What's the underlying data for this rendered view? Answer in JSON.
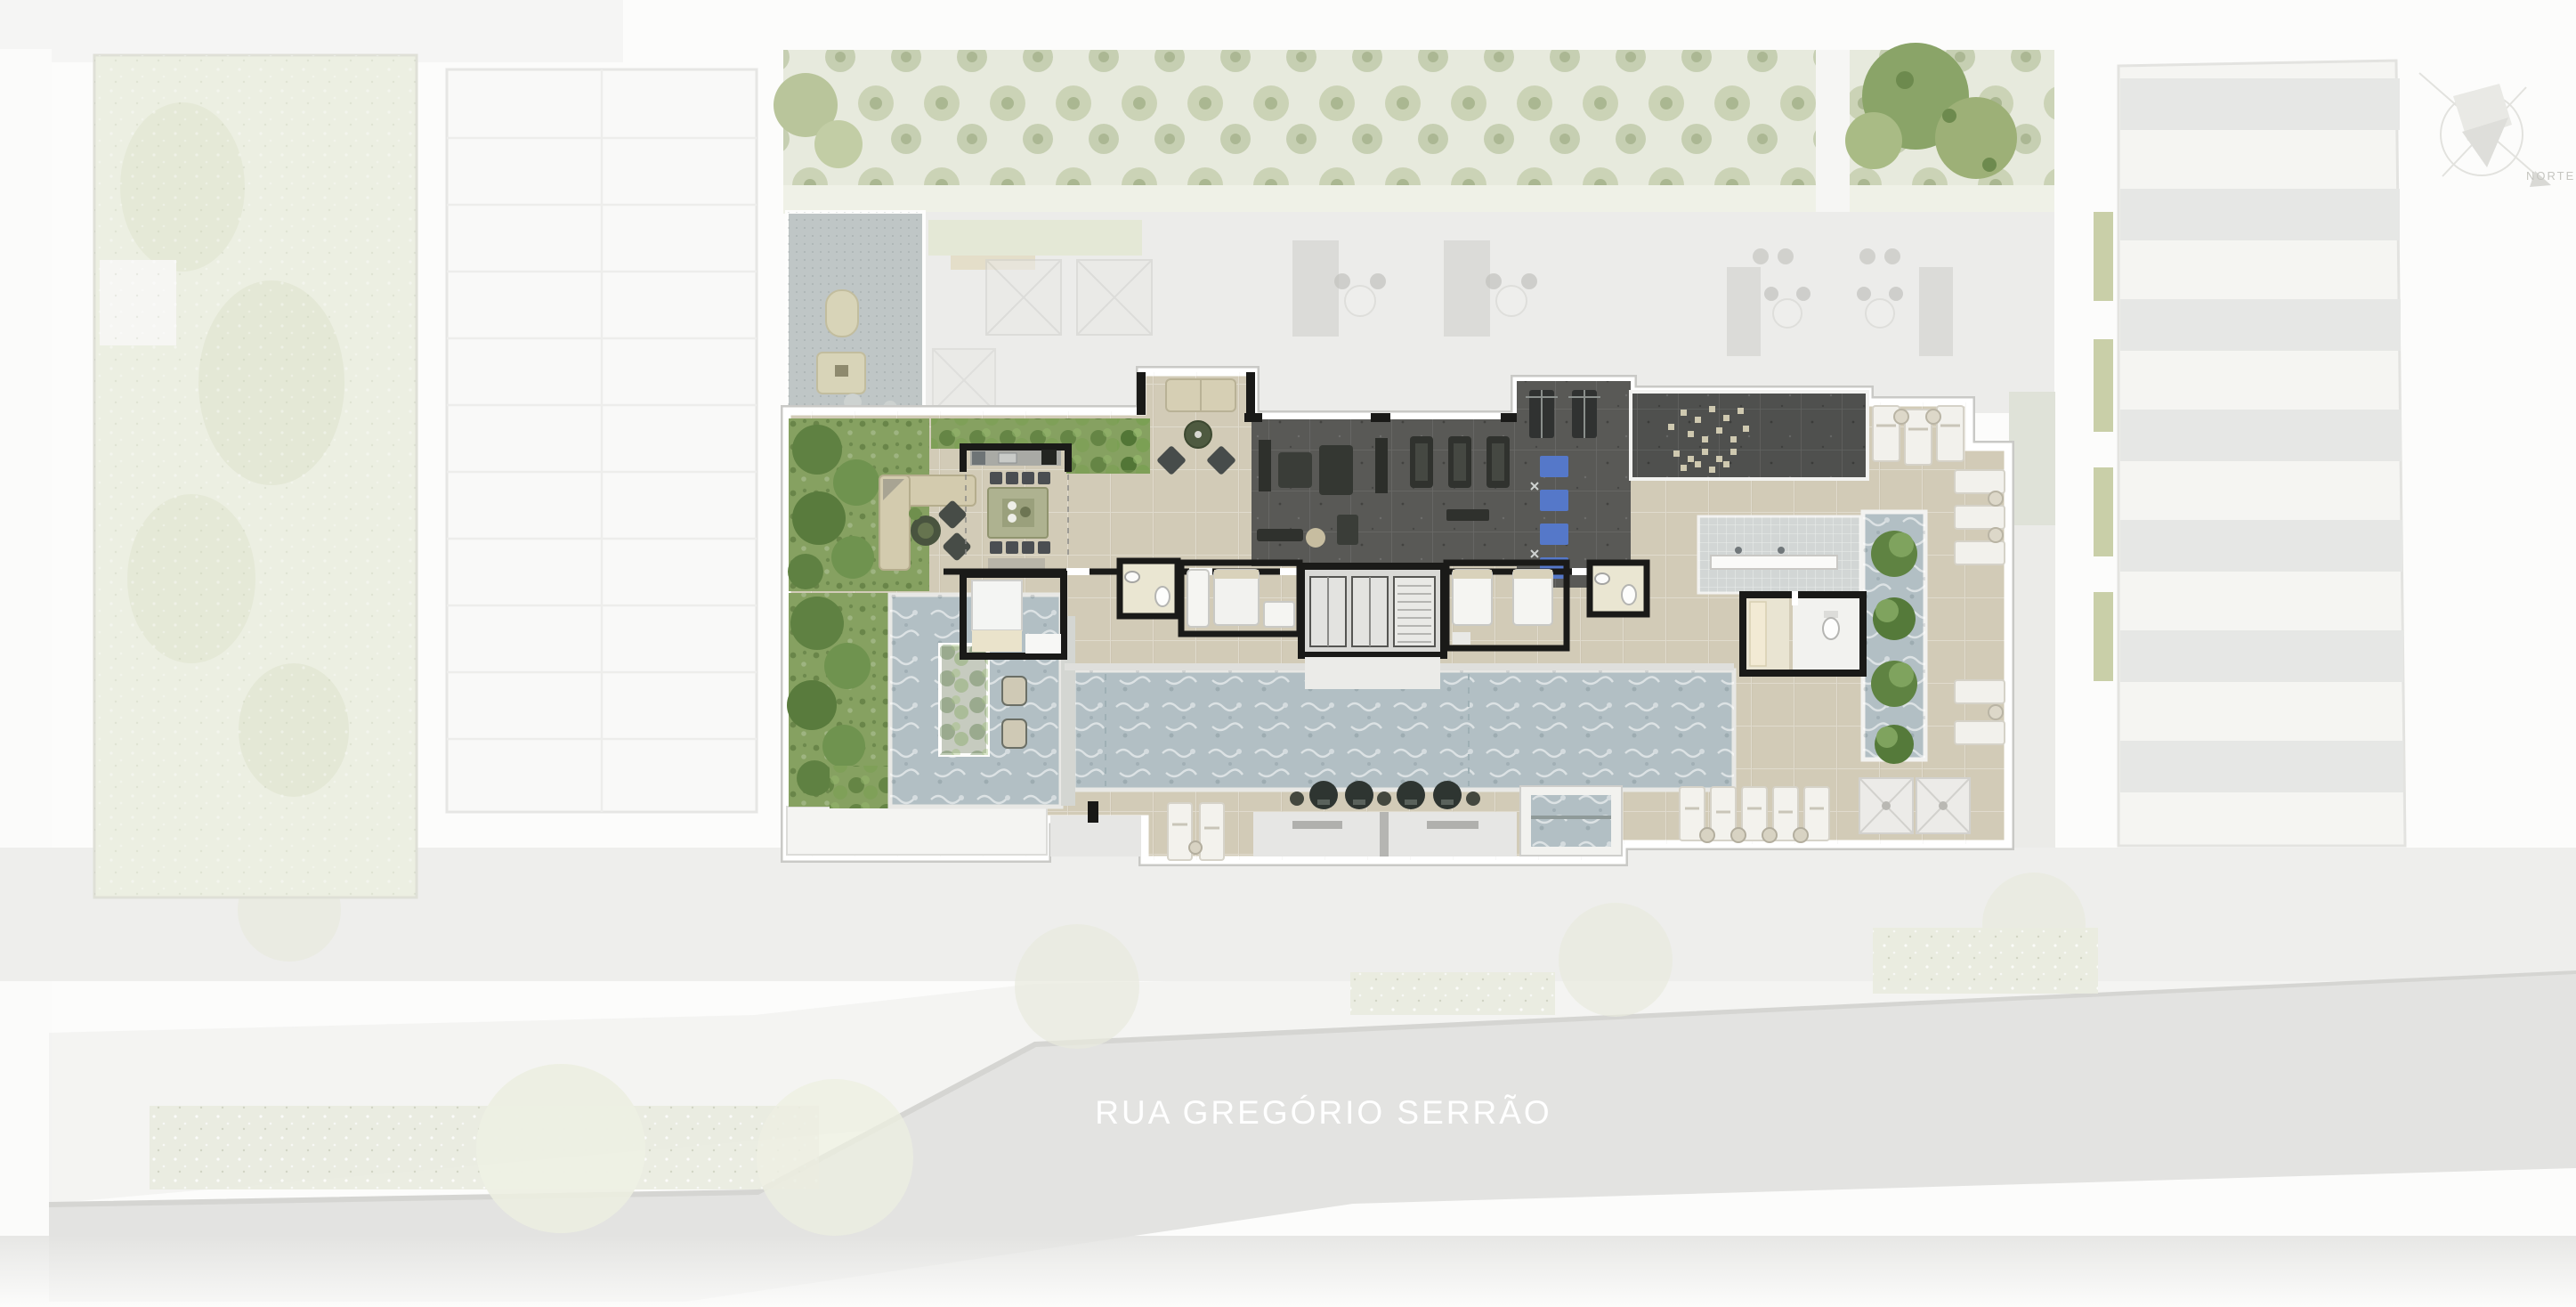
{
  "street": {
    "label": "RUA GREGÓRIO SERRÃO"
  },
  "compass": {
    "label": "NORTE"
  },
  "palette": {
    "page_bg": "#fcfcfb",
    "street": "#e3e3e1",
    "sidewalk": "#eeeeec",
    "street_text": "#ffffff",
    "garden": "#ecefe2",
    "faded_green": "#e7eadd",
    "terrace": "#ececea",
    "court": "#bfc6c6",
    "neighbor": "#f5f5f2",
    "neighbor_stripe": "#e6e7e5",
    "deck_wood": "#d2cbb7",
    "trim_white": "#ffffff",
    "trim_edge": "#c7c7c4",
    "pool_water": "#b2bfc4",
    "gym_floor": "#595956",
    "lounge_dark": "#4f504e",
    "mosaic": "#d2d6d5",
    "mat_blue": "#5578c9",
    "wall_black": "#1a1a18",
    "room_floor": "#e8e3d0",
    "white_object": "#f3f2ee",
    "porch_gray": "#e6e6e4",
    "chair_dark": "#2e3531",
    "vegetation": "#86a161",
    "vegetation_dark": "#5f8142",
    "compass_line": "#e2e2de",
    "compass_text": "#c6c6c1"
  }
}
